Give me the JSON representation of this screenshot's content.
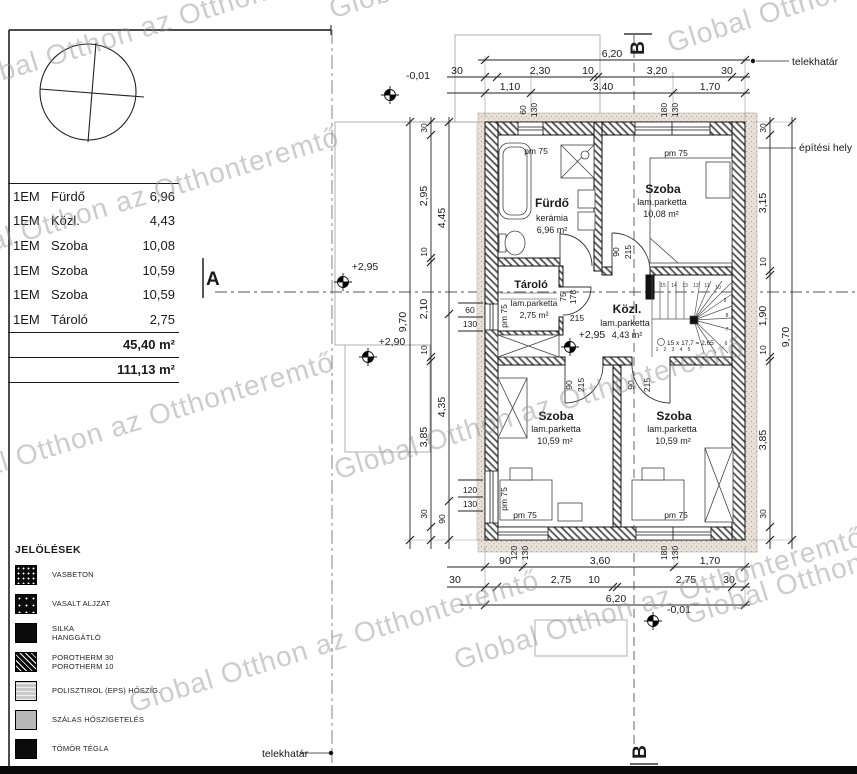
{
  "watermark_text": "Global Otthon az Otthonteremtő",
  "table": {
    "rows": [
      {
        "floor": "1EM",
        "name": "Fürdő",
        "area": "6,96"
      },
      {
        "floor": "1EM",
        "name": "Közl.",
        "area": "4,43"
      },
      {
        "floor": "1EM",
        "name": "Szoba",
        "area": "10,08"
      },
      {
        "floor": "1EM",
        "name": "Szoba",
        "area": "10,59"
      },
      {
        "floor": "1EM",
        "name": "Szoba",
        "area": "10,59"
      },
      {
        "floor": "1EM",
        "name": "Tároló",
        "area": "2,75"
      }
    ],
    "subtotal": "45,40 m²",
    "total": "111,13 m²"
  },
  "legend": {
    "title": "JELÖLÉSEK",
    "items": [
      {
        "line1": "VASBETON",
        "swatch": "reinforced-concrete"
      },
      {
        "line1": "VASALT ALJZAT",
        "swatch": "reinforced-screed"
      },
      {
        "line1": "SILKA",
        "line2": "HANGGÁTLÓ",
        "swatch": "silka-block"
      },
      {
        "line1": "POROTHERM 30",
        "line2": "POROTHERM 10",
        "swatch": "porotherm-hatch"
      },
      {
        "line1": "POLISZTIROL (EPS) HŐSZIG.",
        "swatch": "eps-insulation"
      },
      {
        "line1": "SZÁLAS HŐSZIGETELÉS",
        "swatch": "fiber-insulation"
      },
      {
        "line1": "TÖMÖR TÉGLA",
        "swatch": "solid-brick"
      }
    ]
  },
  "rooms": {
    "furdo": {
      "name": "Fürdő",
      "mat": "kerámia",
      "area": "6,96 m²"
    },
    "szoba1": {
      "name": "Szoba",
      "mat": "lam.parketta",
      "area": "10,08 m²"
    },
    "tarolo": {
      "name": "Tároló",
      "mat": "lam.parketta",
      "area": "2,75 m²"
    },
    "kozl": {
      "name": "Közl.",
      "mat": "lam.parketta",
      "area": "4,43 m²"
    },
    "szoba_bl": {
      "name": "Szoba",
      "mat": "lam.parketta",
      "area": "10,59 m²"
    },
    "szoba_br": {
      "name": "Szoba",
      "mat": "lam.parketta",
      "area": "10,59 m²"
    }
  },
  "labels": {
    "pm75": "pm 75",
    "telekhatar": "telekhatár",
    "epitesi_hely": "építési hely",
    "section_a": "A",
    "section_b": "B"
  },
  "levels": {
    "minus001": "-0,01",
    "plus295": "+2,95",
    "plus290": "+2,90"
  },
  "stairs": {
    "note": "15 x 17,7 = 2,65",
    "numbers": [
      "1",
      "2",
      "3",
      "4",
      "5",
      "6",
      "7",
      "8",
      "9",
      "10",
      "11",
      "12",
      "13",
      "14",
      "15"
    ]
  },
  "dims": {
    "top_total": "6,20",
    "top_chain": [
      "30",
      "2,30",
      "10",
      "3,20",
      "30"
    ],
    "top_spans": [
      "1,10",
      "3,40",
      "1,70"
    ],
    "top_win1": [
      "60",
      "130"
    ],
    "top_win2": [
      "180",
      "130"
    ],
    "bottom_total": "6,20",
    "bottom_chain": [
      "30",
      "2,75",
      "10",
      "2,75",
      "30"
    ],
    "bottom_spans": [
      "90",
      "3,60",
      "1,70"
    ],
    "bottom_win1": [
      "120",
      "130"
    ],
    "bottom_win2": [
      "180",
      "130"
    ],
    "right_total": "9,70",
    "right_chain": [
      "30",
      "3,15",
      "10",
      "1,90",
      "10",
      "3,85",
      "30"
    ],
    "left_total": "9,70",
    "left_chain": [
      "30",
      "2,95",
      "10",
      "2,10",
      "10",
      "3,85",
      "30"
    ],
    "left_chain2": [
      "4,45",
      "4,35",
      "90"
    ],
    "left_win1": [
      "60",
      "130"
    ],
    "left_win2": [
      "120",
      "130"
    ],
    "door_top": [
      "90",
      "215"
    ],
    "door_bath": [
      "75",
      "178"
    ],
    "door_tarolo": "215",
    "door_bl": [
      "90",
      "215"
    ],
    "door_br": [
      "90",
      "215"
    ]
  },
  "colors": {
    "line": "#1a1a1a",
    "watermark": "#8f8f8f",
    "insulation": "#e7e1da"
  }
}
